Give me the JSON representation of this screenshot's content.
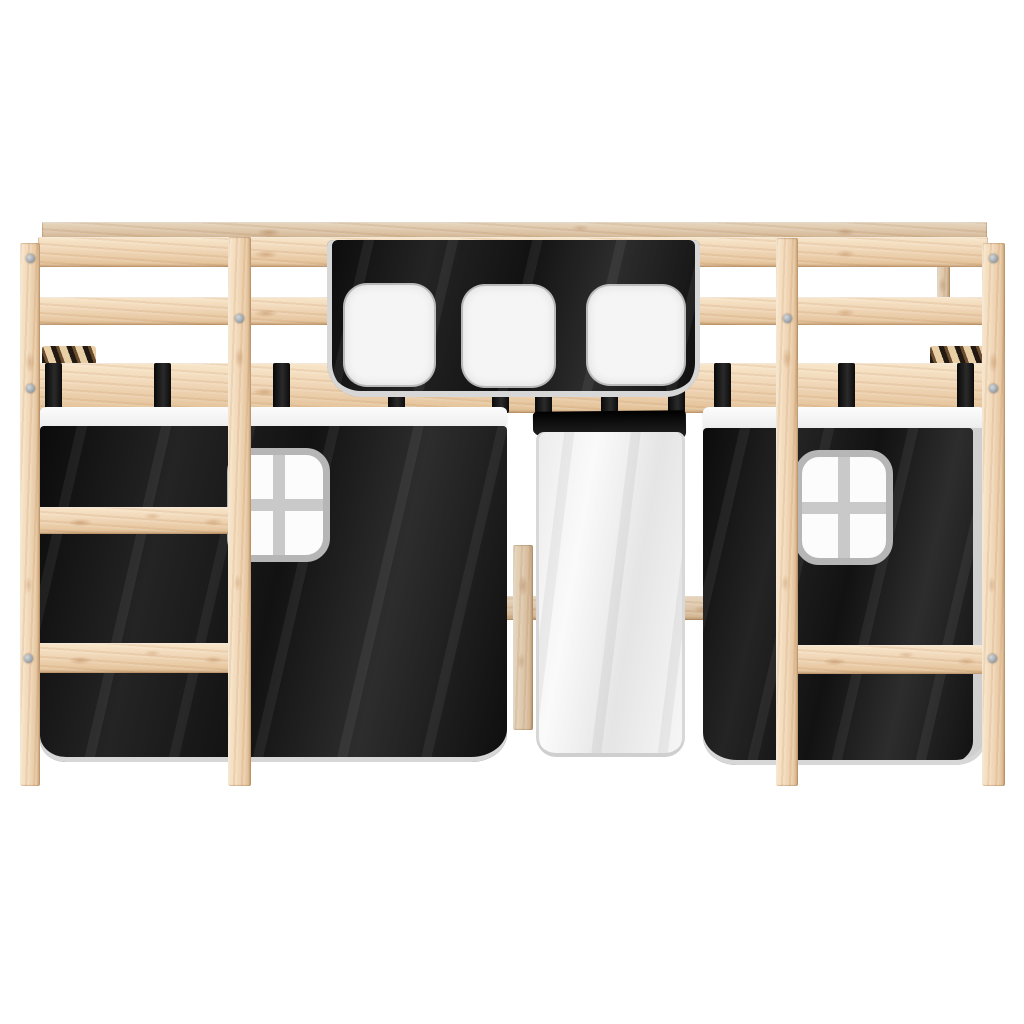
{
  "meta": {
    "domain": "Natural-Image",
    "subject": "Kids loft bed made of light solid pine wood with a white-and-black play curtain set, photographed front-on against a plain white studio background",
    "background_color": "#ffffff"
  },
  "colors": {
    "bg": "#ffffff",
    "wood_base": "#f0d6b6",
    "wood_light": "#f8e6ca",
    "wood_shadow": "#e2c096",
    "wood_grain": "#c9996a",
    "fabric_black": "#161616",
    "fabric_black_highlight": "#2d2d2d",
    "fabric_white": "#f4f4f4",
    "fabric_white_shade": "#e3e3e3",
    "trim_gray": "#d7d7d7",
    "window_frame_gray": "#b6b6b6",
    "window_mullion_gray": "#c9c9c9",
    "screw_gray": "#98a0a6",
    "slat_dark": "#221a12"
  },
  "scene": {
    "frame": {
      "material": "solid pine wood",
      "top_guardrail_planks": 2,
      "wide_side_rail": 1,
      "vertical_posts": [
        "left-outer",
        "left-inner",
        "right-inner",
        "right-outer"
      ],
      "left_ladder_rungs": 2,
      "right_ladder_rungs": 1,
      "visible_screws": 8,
      "slat_stacks_visible_at_ends": 2
    },
    "valance": {
      "color": "black",
      "trim_color": "white-gray",
      "windows": 3,
      "window_shape": "rounded square, plain white"
    },
    "curtains": [
      {
        "position": "left",
        "body_color": "black",
        "top_band": "white",
        "window": {
          "style": "four-pane cross",
          "frame": "gray-white"
        },
        "straps": 5
      },
      {
        "position": "center",
        "body_color": "white",
        "top_band": "black",
        "window": null,
        "straps": 3
      },
      {
        "position": "right",
        "body_color": "black",
        "top_band": "white",
        "window": {
          "style": "four-pane cross",
          "frame": "gray-white"
        },
        "straps": 3
      }
    ]
  }
}
